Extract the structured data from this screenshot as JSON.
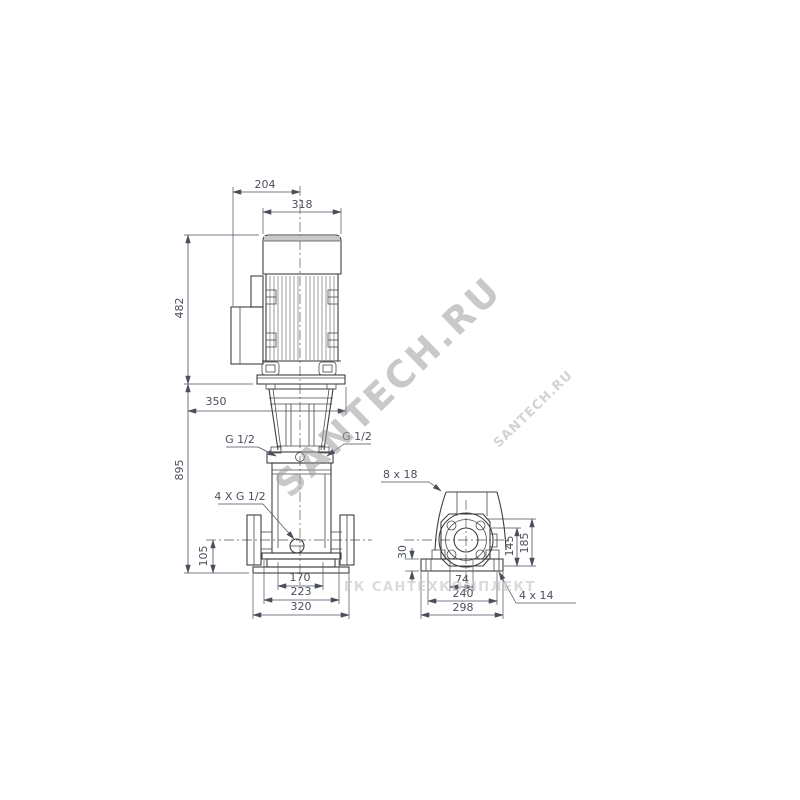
{
  "drawing": {
    "front_view": {
      "dim_top_width": "204",
      "dim_motor_width": "318",
      "dim_motor_height": "482",
      "dim_stool_width": "350",
      "dim_pump_height": "895",
      "dim_port_height": "105",
      "dim_base_inner": "170",
      "dim_base_mid": "223",
      "dim_base_outer": "320",
      "label_port_left": "G 1/2",
      "label_port_right": "G 1/2",
      "label_plugs": "4 X G 1/2"
    },
    "side_view": {
      "label_slots": "8 x 18",
      "dim_base_thickness": "30",
      "dim_flange_height": "145",
      "dim_top_height": "185",
      "dim_holes_inner": "74",
      "dim_holes_spacing": "240",
      "dim_base_width": "298",
      "label_base_holes": "4 x 14"
    },
    "watermark": {
      "main": "SANTECH.RU",
      "secondary": "SANTECH.RU",
      "footer": "ГК САНТЕХКОМПЛЕКТ"
    },
    "colors": {
      "line": "#3f3f3f",
      "dim_text": "#4a4f5c",
      "watermark": "#9d9d9d"
    }
  }
}
